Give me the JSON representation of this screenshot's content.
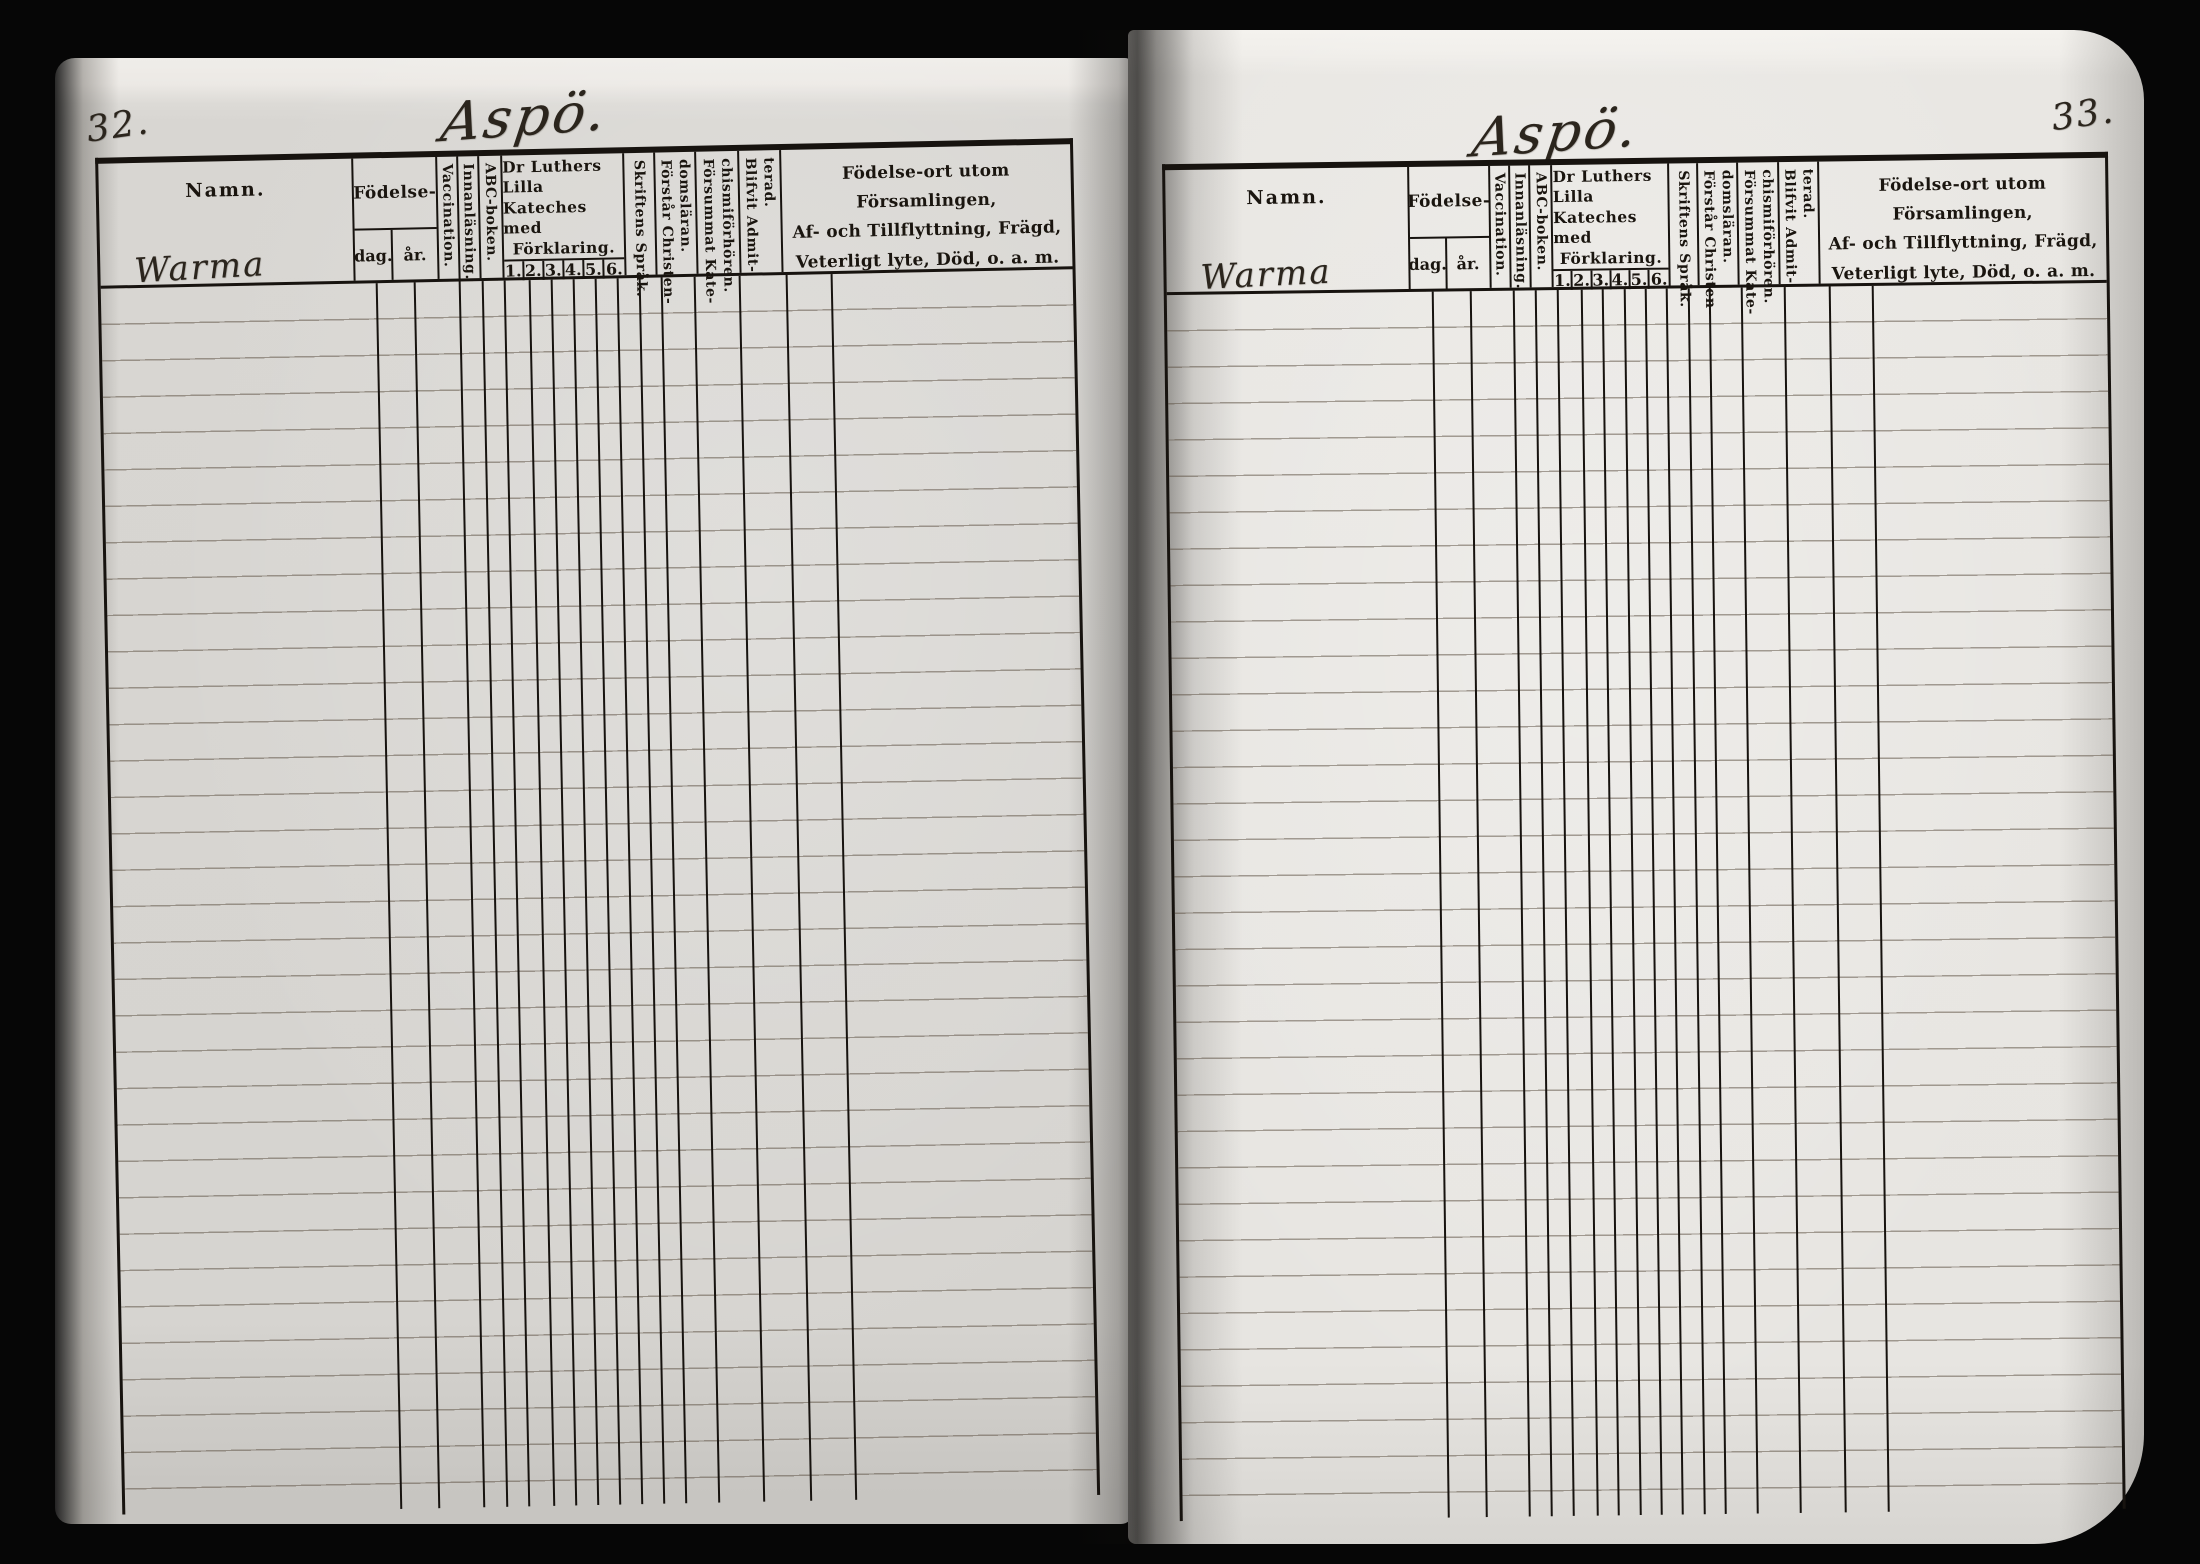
{
  "pages": {
    "left": {
      "page_number": "32.",
      "title": "Aspö.",
      "name_entry": "Warma"
    },
    "right": {
      "page_number": "33.",
      "title": "Aspö.",
      "name_entry": "Warma"
    }
  },
  "columns": {
    "namn": "Namn.",
    "birth_group": "Födelse-",
    "birth_day": "dag.",
    "birth_year": "år.",
    "vaccination": "Vaccination.",
    "reading": "Innanläsning.",
    "abc_book": "ABC-boken.",
    "catechism_title_lines": [
      "Dr Luthers Lilla",
      "Kateches med",
      "Förklaring."
    ],
    "catechism_grades": [
      "1.",
      "2.",
      "3.",
      "4.",
      "5.",
      "6."
    ],
    "scripture_language": "Skriftens Språk.",
    "understands_lines": [
      "Förstår Christen-",
      "domsläran."
    ],
    "missed_catechism_lines": [
      "Försummat Kate-",
      "chismiförhören."
    ],
    "admitted_lines": [
      "Blifvit Admit-",
      "terad."
    ],
    "remarks_lines": [
      "Födelse-ort utom Församlingen,",
      "Af- och Tillflyttning, Frägd,",
      "Veterligt lyte, Död, o. a. m."
    ]
  },
  "colors": {
    "background": "#060606",
    "paper_left": "#d6d4d0",
    "paper_right": "#e7e5e1",
    "table_line": "#17130f",
    "ruled_line": "#5c5042",
    "printed_ink": "#1a150f",
    "handwriting_ink": "#2b251d"
  }
}
